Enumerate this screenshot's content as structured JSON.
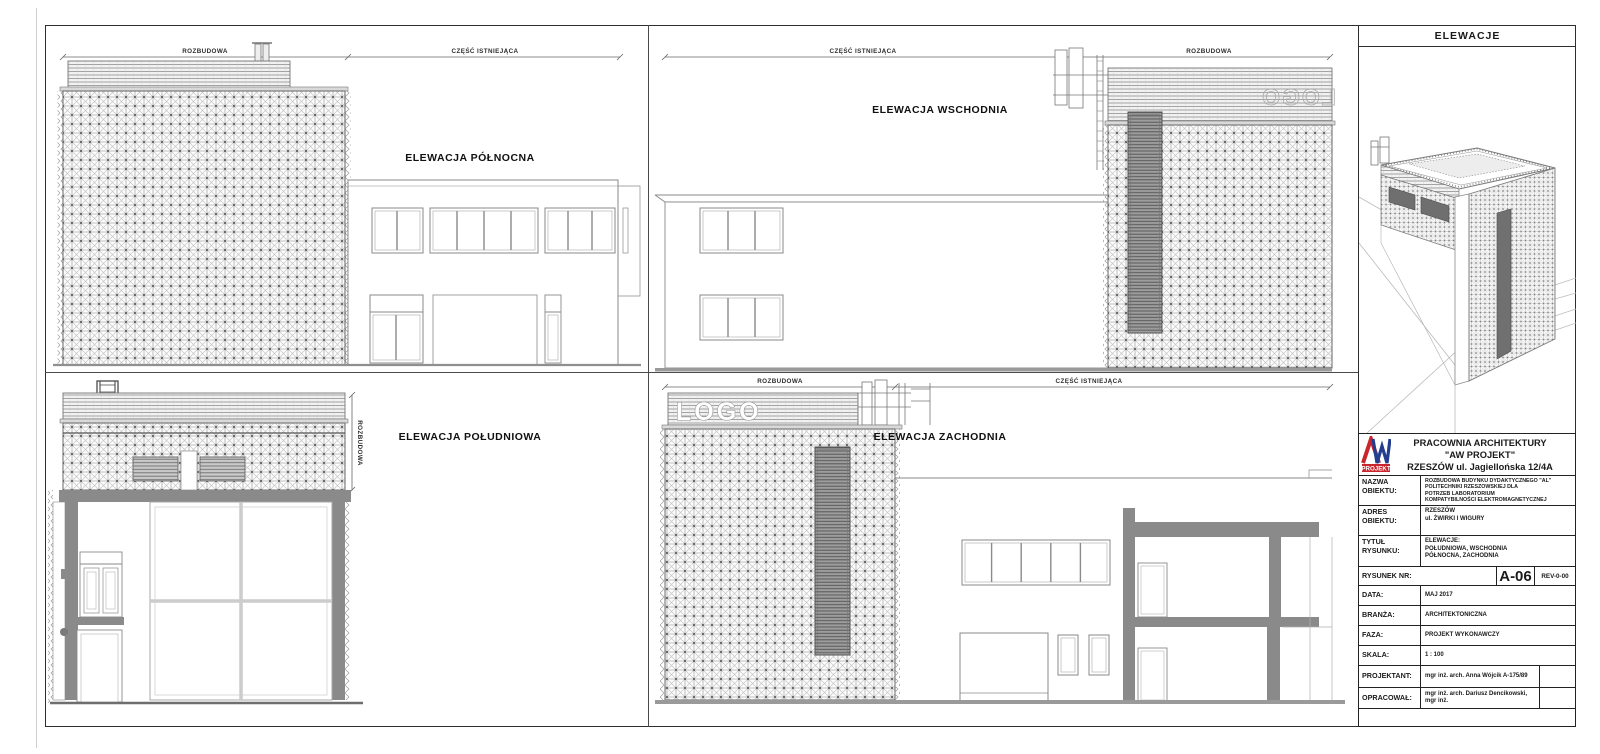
{
  "sheet": {
    "header_title": "ELEWACJE"
  },
  "elevations": {
    "north": {
      "title": "ELEWACJA PÓŁNOCNA",
      "dim_left": "ROZBUDOWA",
      "dim_right": "CZĘŚĆ ISTNIEJĄCA"
    },
    "east": {
      "title": "ELEWACJA WSCHODNIA",
      "dim_left": "CZĘŚĆ ISTNIEJĄCA",
      "dim_right": "ROZBUDOWA",
      "logo_back": "LOGO"
    },
    "south": {
      "title": "ELEWACJA POŁUDNIOWA",
      "dim_vertical": "ROZBUDOWA"
    },
    "west": {
      "title": "ELEWACJA ZACHODNIA",
      "dim_left": "ROZBUDOWA",
      "dim_right": "CZĘŚĆ ISTNIEJĄCA",
      "logo_text": "LOGO"
    }
  },
  "title_block": {
    "company": {
      "name": "PRACOWNIA ARCHITEKTURY\n\"AW PROJEKT\"\nRZESZÓW ul. Jagiellońska 12/4A",
      "logo_text": "PROJEKT"
    },
    "nazwa": {
      "label": "NAZWA\nOBIEKTU:",
      "value": "ROZBUDOWA BUDYNKU DYDAKTYCZNEGO \"AL\"\nPOLITECHNIKI RZESZOWSKIEJ DLA\nPOTRZEB LABORATORIUM\nKOMPATYBILNOŚCI ELEKTROMAGNETYCZNEJ"
    },
    "adres": {
      "label": "ADRES\nOBIEKTU:",
      "value": "RZESZÓW\nul. ŻWIRKI I WIGURY"
    },
    "tytul": {
      "label": "TYTUŁ\nRYSUNKU:",
      "value": "ELEWACJE:\nPOŁUDNIOWA, WSCHODNIA\nPÓŁNOCNA, ZACHODNIA"
    },
    "rysunek": {
      "label": "RYSUNEK NR:",
      "number": "A-06",
      "rev": "REV-0-00"
    },
    "data": {
      "label": "DATA:",
      "value": "MAJ 2017"
    },
    "branza": {
      "label": "BRANŻA:",
      "value": "ARCHITEKTONICZNA"
    },
    "faza": {
      "label": "FAZA:",
      "value": "PROJEKT WYKONAWCZY"
    },
    "skala": {
      "label": "SKALA:",
      "value": "1 : 100"
    },
    "projektant": {
      "label": "PROJEKTANT:",
      "value": "mgr inż. arch. Anna Wójcik A-175/89"
    },
    "opracowal": {
      "label": "OPRACOWAŁ:",
      "value": "mgr inż. arch. Dariusz Dencikowski, mgr inż."
    }
  },
  "colors": {
    "logo_red": "#c9252c",
    "logo_blue": "#233e8f",
    "cut_gray": "#8a8a8a"
  }
}
